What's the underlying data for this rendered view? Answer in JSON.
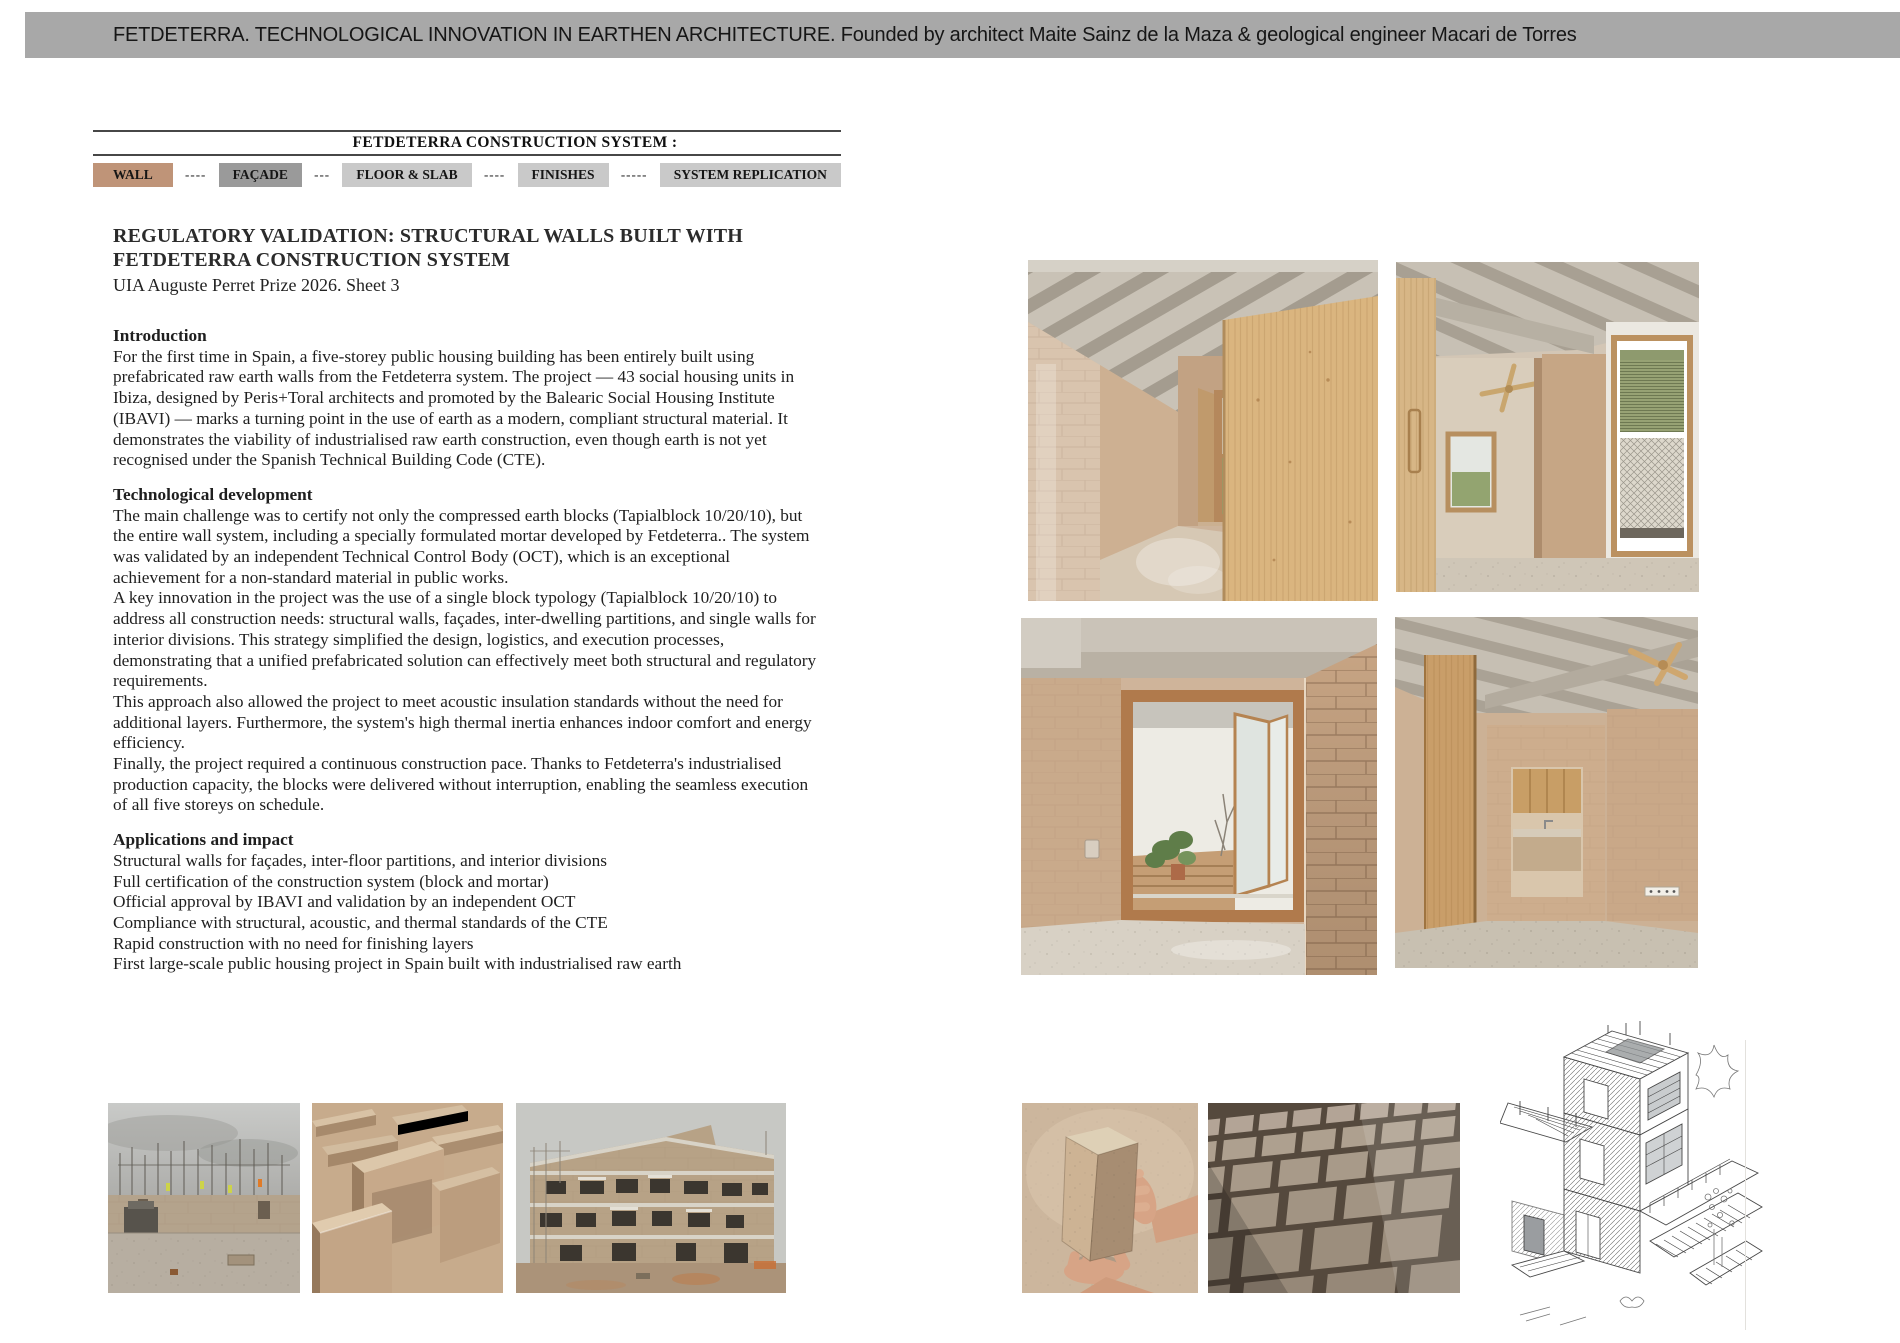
{
  "header": {
    "title": "FETDETERRA. TECHNOLOGICAL INNOVATION IN EARTHEN ARCHITECTURE. Founded by architect Maite Sainz de la Maza & geological engineer Macari de Torres"
  },
  "nav": {
    "title": "FETDETERRA CONSTRUCTION SYSTEM :",
    "tabs": [
      {
        "label": "WALL",
        "active": true
      },
      {
        "label": "FAÇADE",
        "active": false
      },
      {
        "label": "FLOOR & SLAB",
        "active": false
      },
      {
        "label": "FINISHES",
        "active": false
      },
      {
        "label": "SYSTEM REPLICATION",
        "active": false
      }
    ],
    "separators": [
      "----",
      "---",
      "----",
      "-----"
    ]
  },
  "title_block": {
    "heading": "REGULATORY VALIDATION: STRUCTURAL WALLS BUILT WITH FETDETERRA CONSTRUCTION SYSTEM",
    "subtitle": "UIA Auguste Perret Prize 2026. Sheet 3"
  },
  "sections": [
    {
      "heading": "Introduction",
      "paragraphs": [
        "For the first time in Spain, a five-storey public housing building has been entirely built using prefabricated raw earth walls from the Fetdeterra system. The project — 43 social housing units in Ibiza, designed by Peris+Toral architects and promoted by the Balearic Social Housing Institute (IBAVI) — marks a turning point in the use of earth as a modern, compliant structural material. It demonstrates the viability of industrialised raw earth construction, even though earth is not yet recognised under the Spanish Technical Building Code (CTE)."
      ]
    },
    {
      "heading": "Technological development",
      "paragraphs": [
        "The main challenge was to certify not only the compressed earth blocks (Tapialblock 10/20/10), but the entire wall system, including a specially formulated mortar developed by Fetdeterra.. The system was validated by an independent Technical Control Body (OCT), which is an exceptional achievement for a non-standard material in public works.",
        "A key innovation in the project was the use of a single block typology (Tapialblock 10/20/10) to address all construction needs: structural walls, façades, inter-dwelling partitions, and single walls for interior divisions. This strategy simplified the design, logistics, and execution processes, demonstrating that a unified prefabricated solution can effectively meet both structural and regulatory requirements.",
        "This approach also allowed the project to meet acoustic insulation standards without the need for additional layers. Furthermore, the system's high thermal inertia enhances indoor comfort and energy efficiency.",
        "Finally, the project required a continuous construction pace. Thanks to Fetdeterra's industrialised production capacity, the blocks were delivered without interruption, enabling the seamless execution of all five storeys on schedule."
      ]
    },
    {
      "heading": "Applications and impact",
      "paragraphs": [
        "Structural walls for façades, inter-floor partitions, and interior divisions",
        "Full certification of the construction system (block and mortar)",
        "Official approval by IBAVI and validation by an independent OCT",
        "Compliance with structural, acoustic, and thermal standards of the CTE",
        "Rapid construction with no need for finishing layers",
        "First large-scale public housing project in Spain built with industrialised raw earth"
      ]
    }
  ],
  "colors": {
    "header_bar": "#a8a8a8",
    "tab_wall_active": "#bf9478",
    "tab_facade": "#9a9a9a",
    "tab_inactive": "#c9c9c9",
    "earth_tone": "#c9a98a"
  }
}
